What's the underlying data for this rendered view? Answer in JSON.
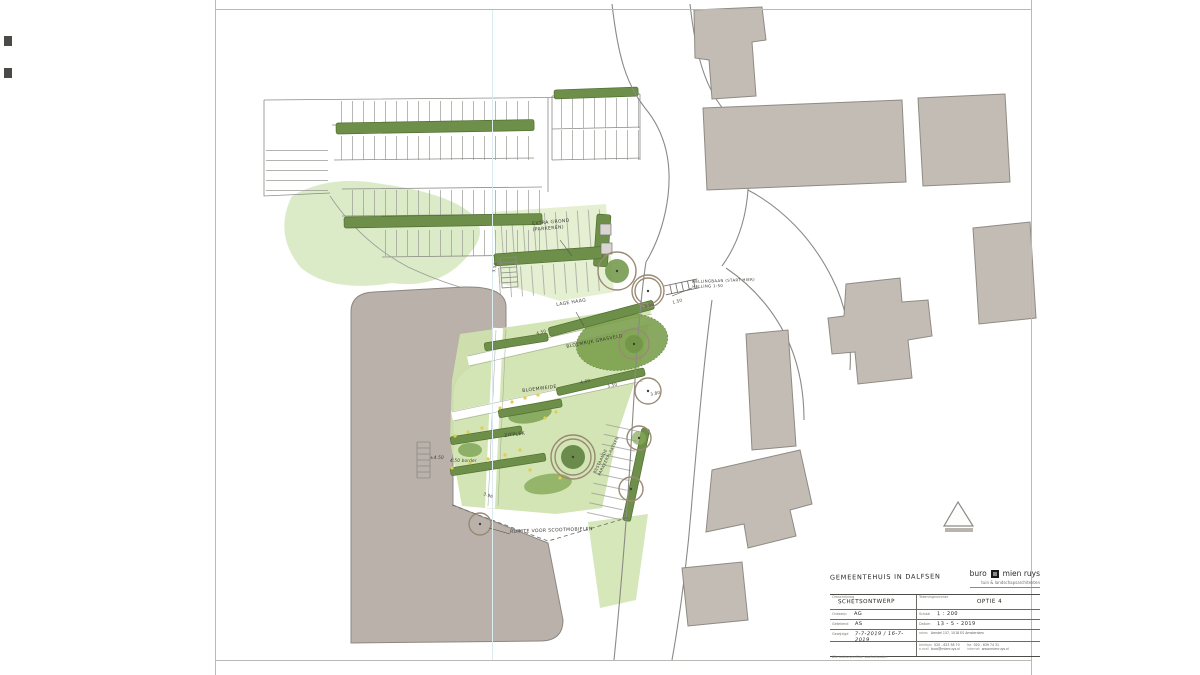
{
  "plan": {
    "annotations": [
      {
        "text": "EXTRA GROND\n(PARKEREN)"
      },
      {
        "text": "LAGE HAAG"
      },
      {
        "text": "HELLINGBAAN (START HIER)\nHELLING 1:50"
      },
      {
        "text": "BLOEMRIJK GRASVELD"
      },
      {
        "text": "BLOEMWEIDE"
      },
      {
        "text": "ZITPLEK"
      },
      {
        "text": "BESTAANDE\nPARKEERPLAATSEN"
      },
      {
        "text": "RUIMTE VOOR SCOOTMOBIELEN"
      }
    ],
    "dimensions": [
      {
        "text": "3.50"
      },
      {
        "text": "4.50"
      },
      {
        "text": "3.50"
      },
      {
        "text": "1.50"
      },
      {
        "text": "4.00"
      },
      {
        "text": "3.50"
      },
      {
        "text": "3.80"
      },
      {
        "text": "3.96"
      },
      {
        "text": "±4.50"
      },
      {
        "text": "4.50 border"
      }
    ],
    "colors": {
      "lawn": "#cfe3ae",
      "canopy": "#7ca04e",
      "hedge": "#6d8f49",
      "building": "#c3bcb5",
      "mass": "#b9b1aa",
      "flower": "#e2cd4a"
    }
  },
  "title_block": {
    "project_title": "GEMEENTEHUIS IN DALFSEN",
    "logo": {
      "word1": "buro",
      "word2": "mien ruys",
      "subtitle": "tuin & landschapsarchitekten"
    },
    "omschrijving_label": "Omschrijving",
    "omschrijving_value": "SCHETSONTWERP",
    "tekeningnummer_label": "Tekeningnummer",
    "tekeningnummer_value": "OPTIE 4",
    "ontwerp_label": "Ontwerp",
    "ontwerp_value": "AG",
    "schaal_label": "Schaal",
    "schaal_value": "1 : 200",
    "getekend_label": "Getekend",
    "getekend_value": "AS",
    "datum_label": "Datum",
    "datum_value": "13 - 5 - 2019",
    "gewijzigd_label": "Gewijzigd",
    "gewijzigd_value": "7-7-2019 / 16-7-2019",
    "copyright": "Alle auteursrechten voorbehouden",
    "address": {
      "adres_label": "adres",
      "adres_value": "Amstel 157, 1018 ES Amsterdam",
      "telefoon_label": "telefoon",
      "telefoon_value": "020 - 623 58 70",
      "fax_label": "fax",
      "fax_value": "020 - 639 74 31",
      "email_label": "e-mail",
      "email_value": "buro@mienruys.nl",
      "internet_label": "internet",
      "internet_value": "www.mienruys.nl"
    }
  }
}
